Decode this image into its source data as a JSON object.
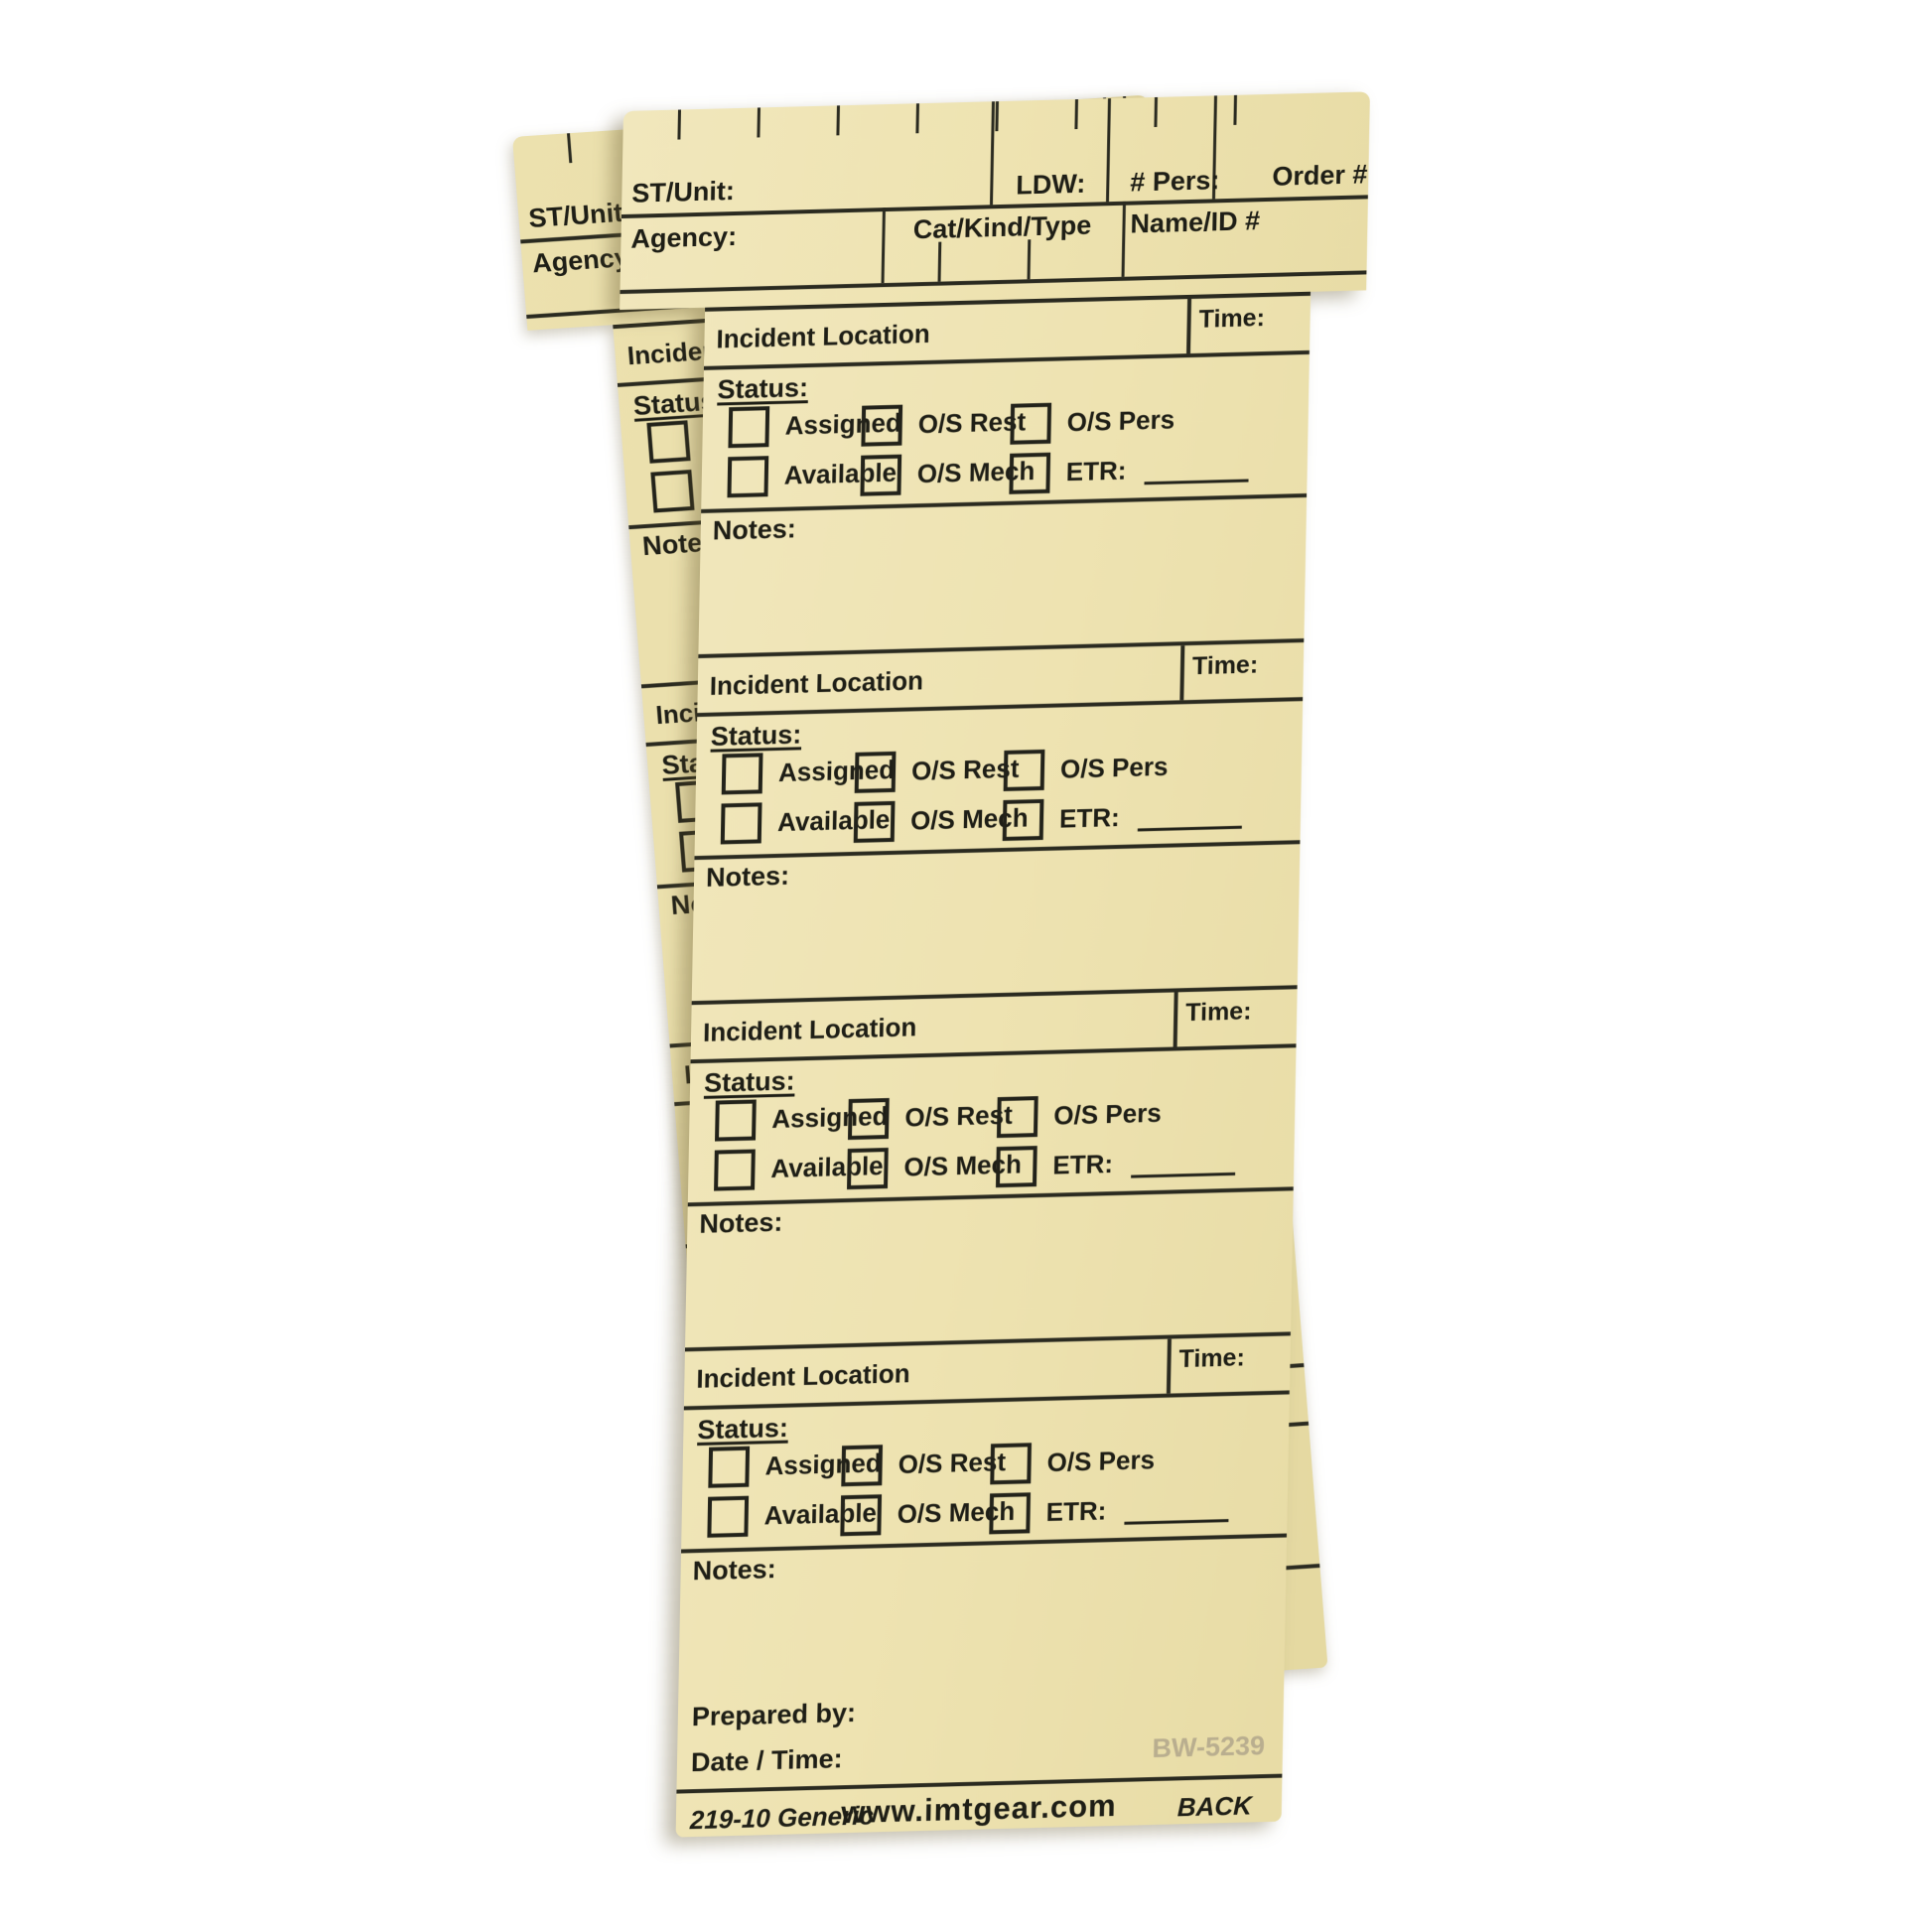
{
  "product": {
    "description": "Two blank manila T-card resource status forms, back side",
    "card_color": "#eee3b1",
    "line_color": "#2a2a20"
  },
  "header": {
    "st_unit": "ST/Unit:",
    "ldw": "LDW:",
    "pers": "# Pers:",
    "order": "Order #",
    "agency": "Agency:",
    "cat_kind_type": "Cat/Kind/Type",
    "name_id": "Name/ID #"
  },
  "section": {
    "incident_location": "Incident Location",
    "time": "Time:",
    "status": "Status:",
    "assigned": "Assigned",
    "available": "Available",
    "os_rest": "O/S Rest",
    "os_mech": "O/S Mech",
    "os_pers": "O/S Pers",
    "etr": "ETR:",
    "notes": "Notes:"
  },
  "footer": {
    "prepared_by": "Prepared by:",
    "date_time": "Date / Time:",
    "watermark": "BW-5239",
    "form_number": "219-10 Generic",
    "website": "www.imtgear.com",
    "side": "BACK"
  }
}
